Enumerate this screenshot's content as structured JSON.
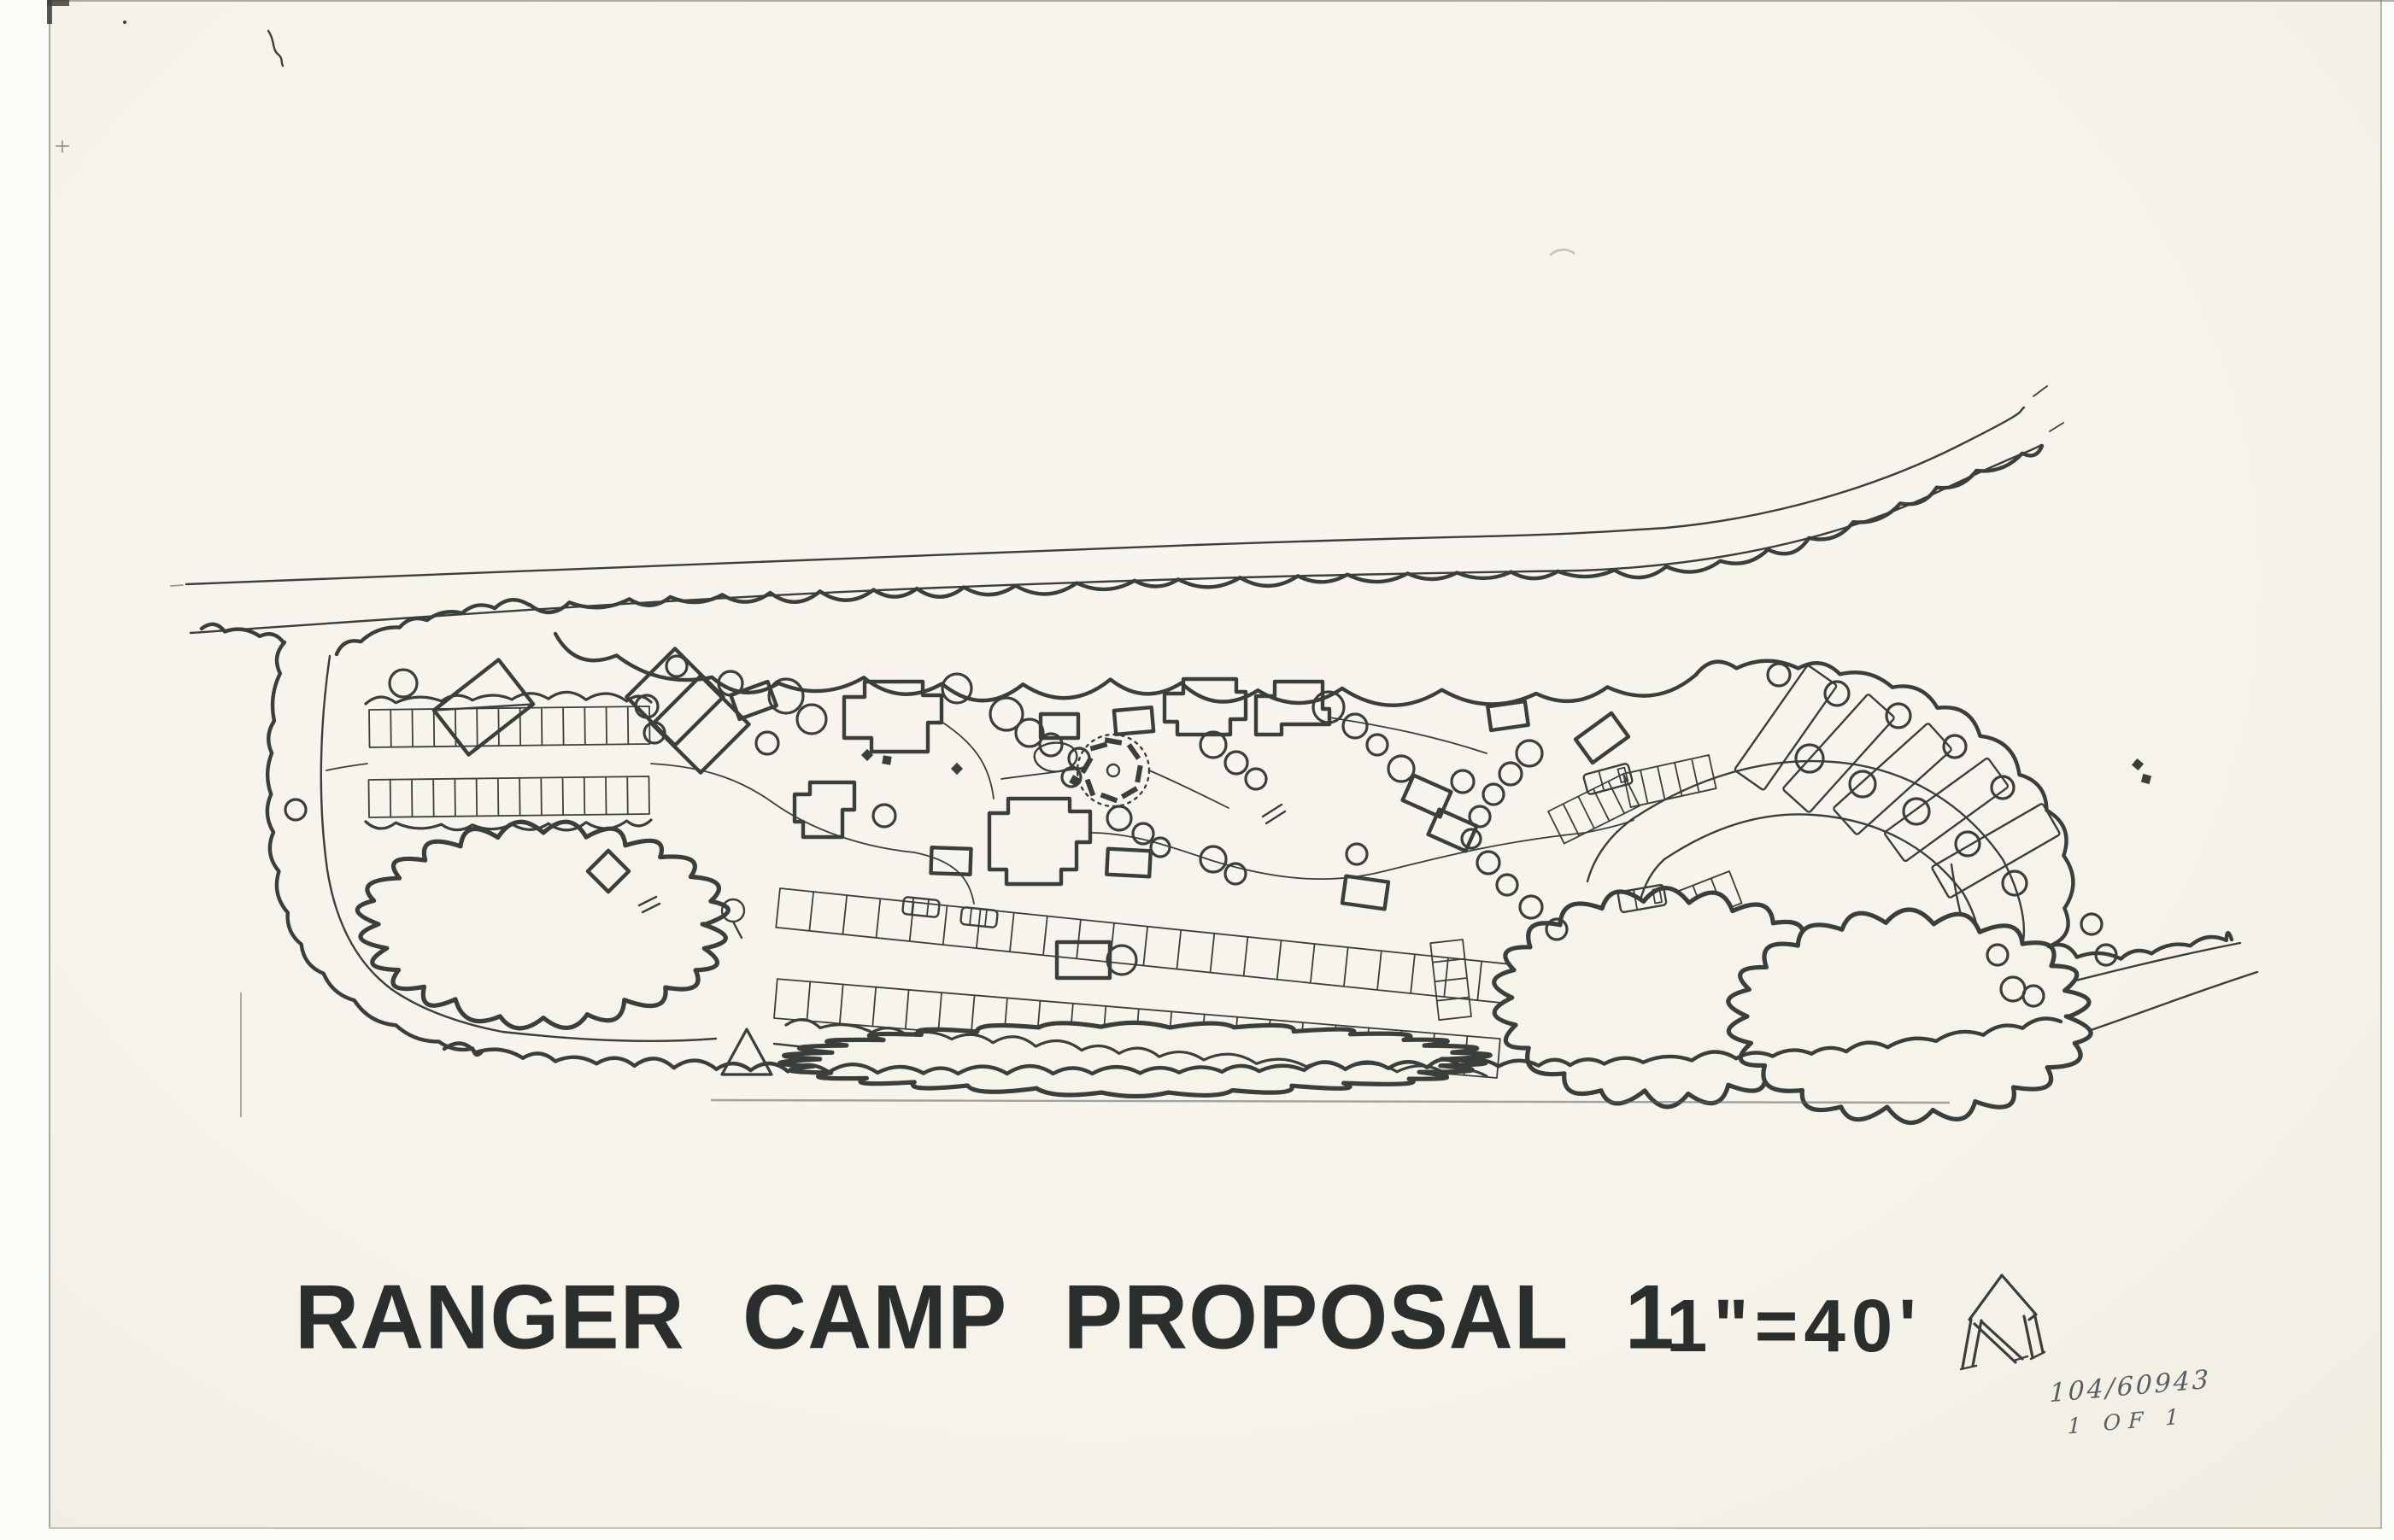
{
  "titlebar": {
    "title": "RANGER CAMP PROPOSAL 1",
    "scale": "1\"=40'"
  },
  "handwritten_note": {
    "line1": "104/60943",
    "line2": "1 OF 1"
  },
  "colors": {
    "paper": "#f6f3eb",
    "scanner_background": "#fbfbf8",
    "ink": "#3b3f3c",
    "title_ink": "#2a2f2d",
    "pencil": "#585d64"
  },
  "icons": {
    "north_arrow": "north-arrow-icon",
    "tree": "tree-icon",
    "car": "car-icon",
    "rv": "rv-icon",
    "picnic_table": "picnic-table-icon",
    "campfire_ring": "campfire-ring-icon"
  }
}
